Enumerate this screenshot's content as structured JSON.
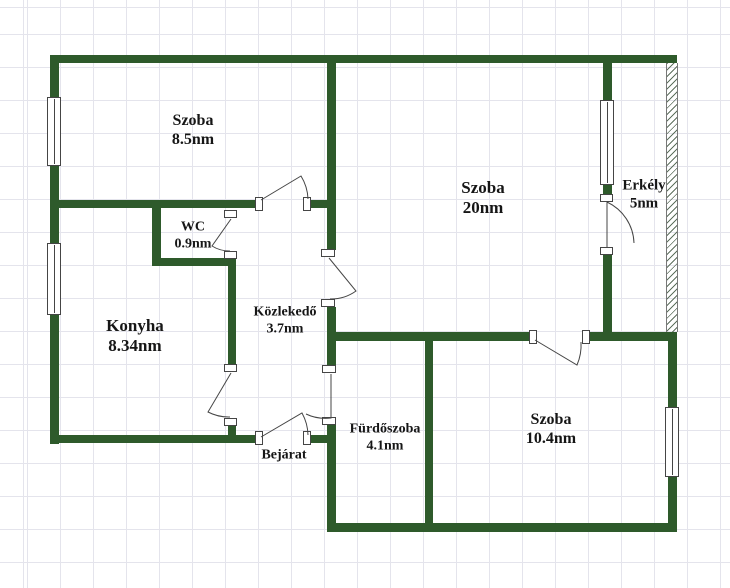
{
  "rooms": {
    "szoba85": {
      "name": "Szoba",
      "area": "8.5nm"
    },
    "szoba20": {
      "name": "Szoba",
      "area": "20nm"
    },
    "erkely": {
      "name": "Erkély",
      "area": "5nm"
    },
    "wc": {
      "name": "WC",
      "area": "0.9nm"
    },
    "konyha": {
      "name": "Konyha",
      "area": "8.34nm"
    },
    "kozlekedo": {
      "name": "Közlekedő",
      "area": "3.7nm"
    },
    "furdoszoba": {
      "name": "Fürdőszoba",
      "area": "4.1nm"
    },
    "szoba104": {
      "name": "Szoba",
      "area": "10.4nm"
    }
  },
  "labels": {
    "entrance": "Bejárat"
  },
  "colors": {
    "wall": "#2e5a2b",
    "door_line": "#454545",
    "grid_line": "#e4e4ec",
    "hatch_line": "#5f715f",
    "text": "#161616"
  }
}
